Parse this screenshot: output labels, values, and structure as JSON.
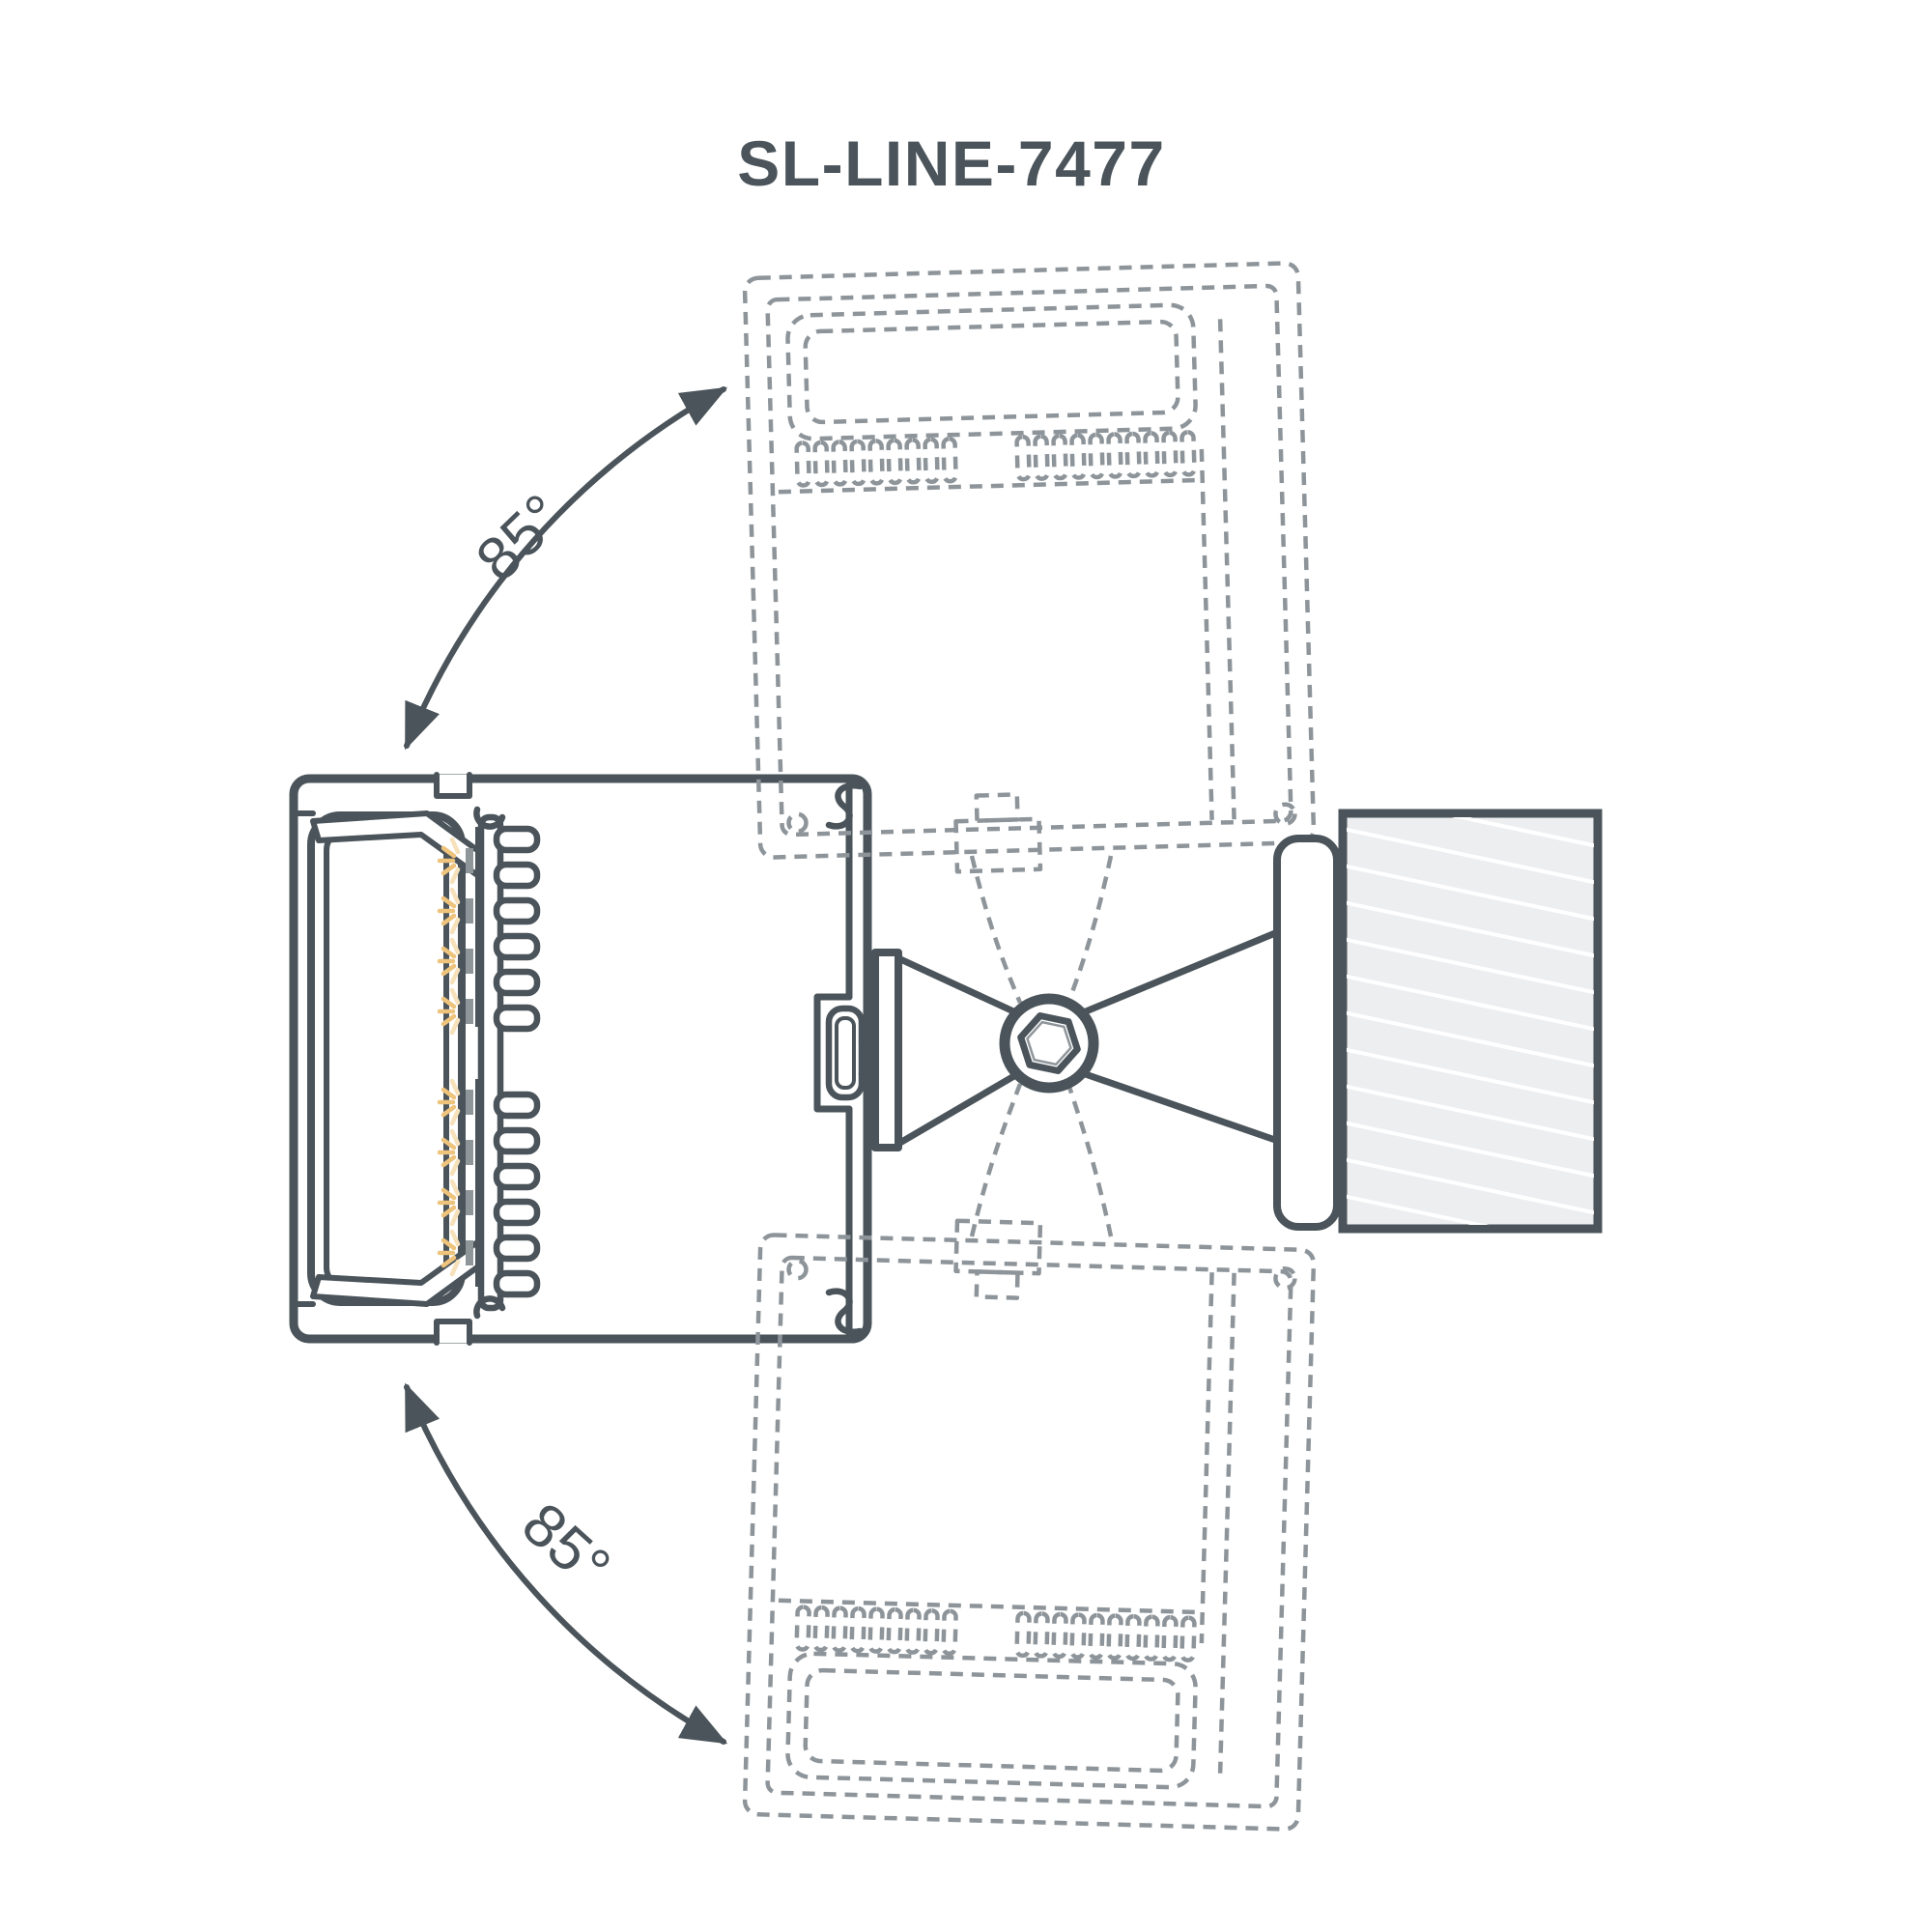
{
  "title": "SL-LINE-7477",
  "angles": {
    "upper": "85°",
    "lower": "85°"
  },
  "colors": {
    "bg": "#ffffff",
    "line": "#4a545a",
    "ghost": "#8e959a",
    "wall": "#eceef0",
    "hatch": "#ffffff",
    "chip": "#8f969a",
    "amber": "#eec37c",
    "pale": "#f6e1bb"
  },
  "drawing": {
    "description": "Cross-section of SL-LINE-7477 adjustable linear wall luminaire",
    "rotation_range_upper": "85°",
    "rotation_range_lower": "85°",
    "parts": [
      "luminaire-body",
      "lens-diffuser",
      "led-strip",
      "heatsink",
      "mounting-bracket",
      "hex-set-screw",
      "wall-plate",
      "wall-section",
      "rotated-position-ghost-up",
      "rotated-position-ghost-down"
    ]
  }
}
